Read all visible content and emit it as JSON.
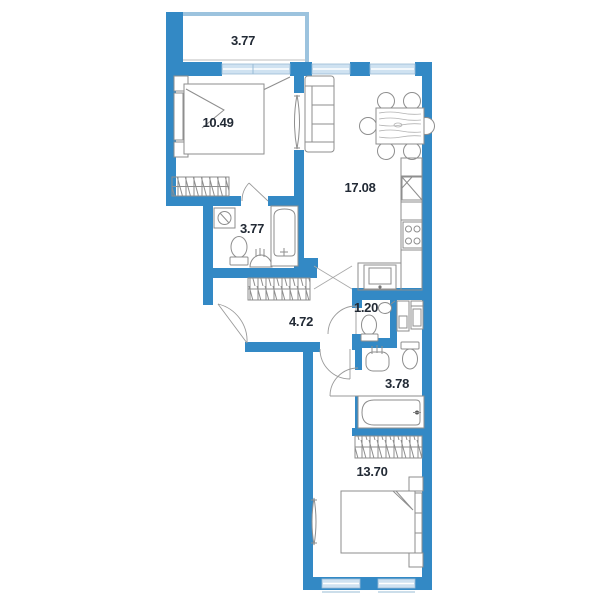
{
  "page": {
    "type": "apartment-floor-plan",
    "width": 600,
    "height": 600
  },
  "colors": {
    "wall": "#3389c5",
    "window_fill": "#cfe2f1",
    "window_frame": "#9abcd6",
    "balcony_wall": "#9cc3de",
    "furniture_line": "#8e8e8e",
    "label_text": "#222a35",
    "background": "#ffffff"
  },
  "rooms": [
    {
      "id": "balcony",
      "area_label": "3.77"
    },
    {
      "id": "bedroom-1",
      "area_label": "10.49"
    },
    {
      "id": "living-kitchen",
      "area_label": "17.08"
    },
    {
      "id": "bathroom-1",
      "area_label": "3.77"
    },
    {
      "id": "hallway",
      "area_label": "4.72"
    },
    {
      "id": "wc",
      "area_label": "1.20"
    },
    {
      "id": "bathroom-2",
      "area_label": "3.78"
    },
    {
      "id": "bedroom-2",
      "area_label": "13.70"
    }
  ]
}
